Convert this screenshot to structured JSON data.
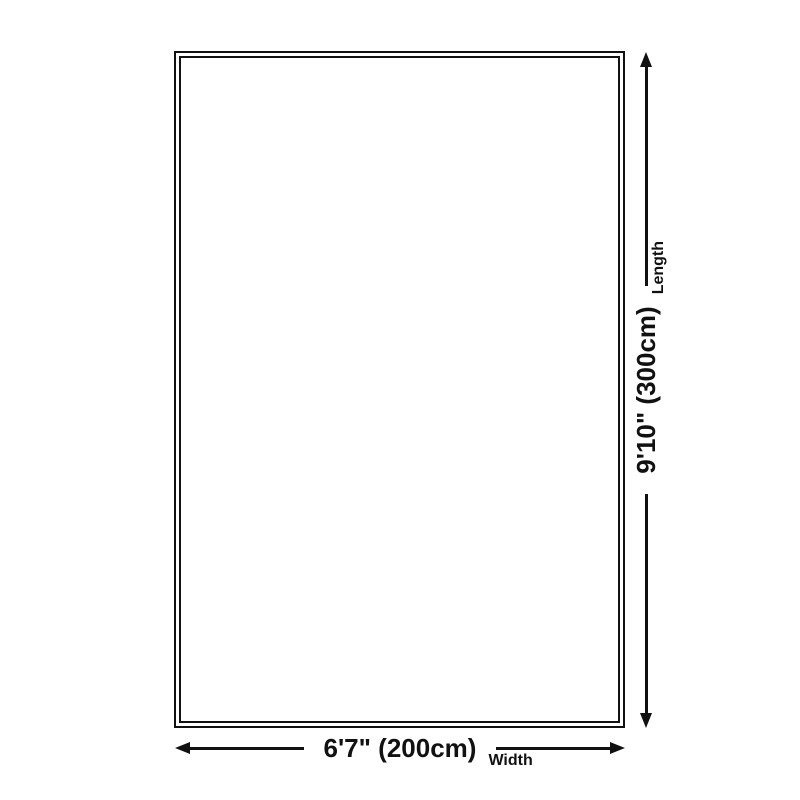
{
  "diagram": {
    "colors": {
      "background": "#ffffff",
      "line": "#111111"
    },
    "rug": {
      "shape": "rectangle-outline"
    },
    "width_dimension": {
      "value": "6'7\" (200cm)",
      "axis_label": "Width",
      "arrow_start_icon": "arrow-left-icon",
      "arrow_end_icon": "arrow-right-icon"
    },
    "length_dimension": {
      "value": "9'10\" (300cm)",
      "axis_label": "Length",
      "arrow_start_icon": "arrow-down-icon",
      "arrow_end_icon": "arrow-up-icon"
    }
  }
}
